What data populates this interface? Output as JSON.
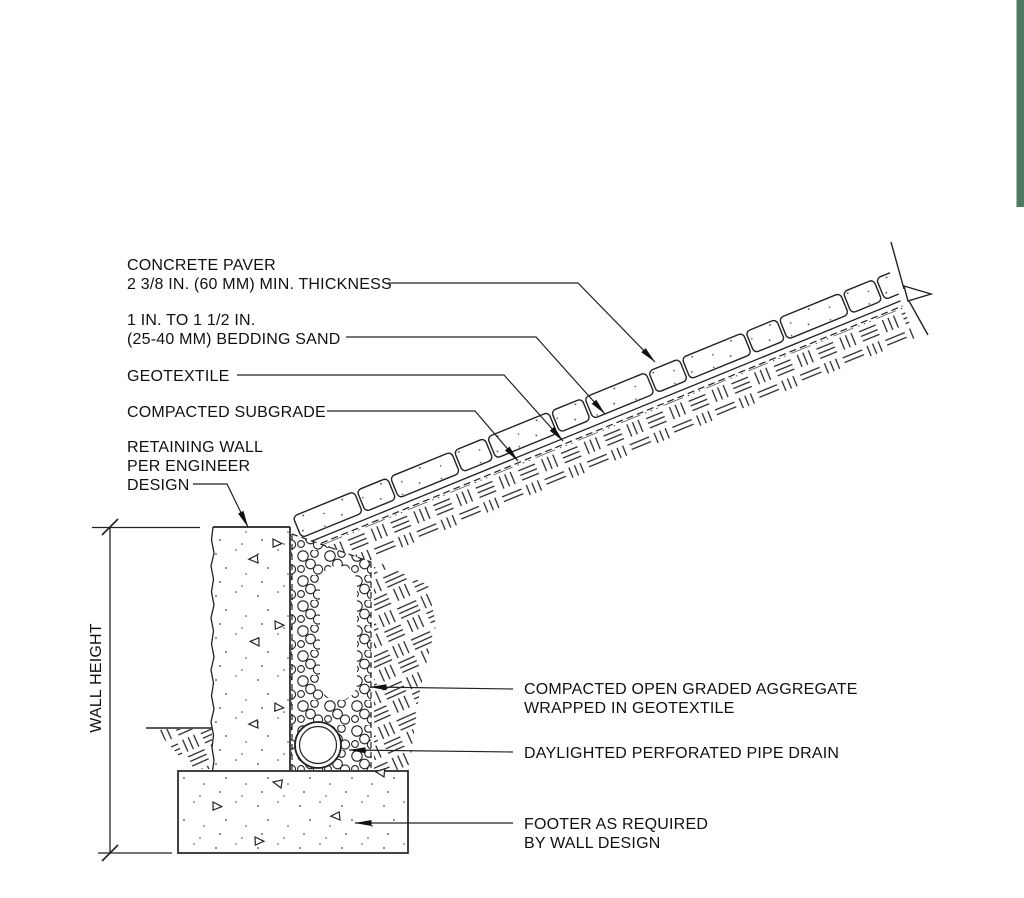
{
  "decor": {
    "green_bar_color": "#4e7a60"
  },
  "labels": {
    "concrete_paver": {
      "line1": "CONCRETE PAVER",
      "line2": "2 3/8 IN. (60 MM) MIN. THICKNESS"
    },
    "bedding_sand": {
      "line1": "1 IN. TO 1 1/2 IN.",
      "line2": "(25-40 MM) BEDDING SAND"
    },
    "geotextile": {
      "text": "GEOTEXTILE"
    },
    "compacted_subgrade": {
      "text": "COMPACTED SUBGRADE"
    },
    "retaining_wall": {
      "line1": "RETAINING WALL",
      "line2": "PER ENGINEER",
      "line3": "DESIGN"
    },
    "wall_height": {
      "text": "WALL HEIGHT"
    },
    "aggregate": {
      "line1": "COMPACTED OPEN GRADED AGGREGATE",
      "line2": "WRAPPED IN GEOTEXTILE"
    },
    "pipe_drain": {
      "text": "DAYLIGHTED PERFORATED PIPE DRAIN"
    },
    "footer": {
      "line1": "FOOTER AS REQUIRED",
      "line2": "BY WALL DESIGN"
    }
  }
}
